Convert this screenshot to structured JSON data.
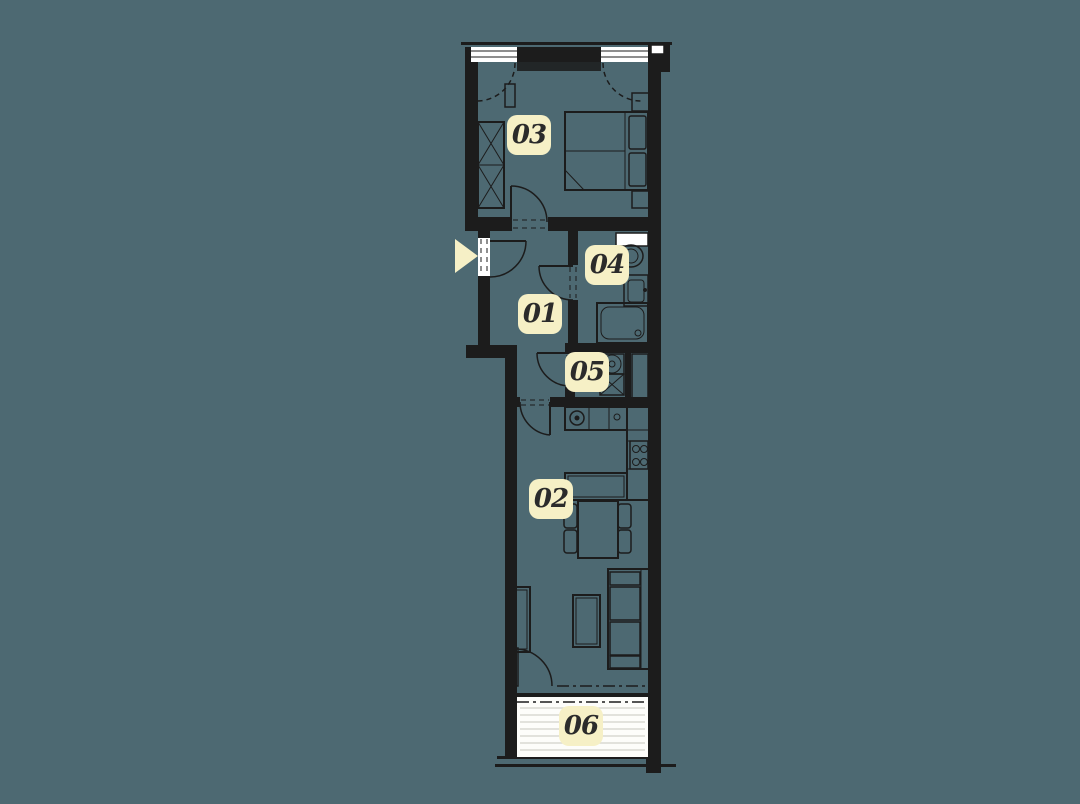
{
  "colors": {
    "background": "#4d6972",
    "wall": "#1c1c1c",
    "window_fill": "#ffffff",
    "balcony_floor": "#fdfdfa",
    "plank_line": "#d9d9d2",
    "label_background": "#f6f0c6",
    "label_text": "#2b2b2b",
    "arrow": "#f6f0c6"
  },
  "rooms": [
    {
      "label": "01"
    },
    {
      "label": "02"
    },
    {
      "label": "03"
    },
    {
      "label": "04"
    },
    {
      "label": "05"
    },
    {
      "label": "06"
    }
  ],
  "markers": {
    "entrance_icon": "entrance-arrow-icon"
  }
}
